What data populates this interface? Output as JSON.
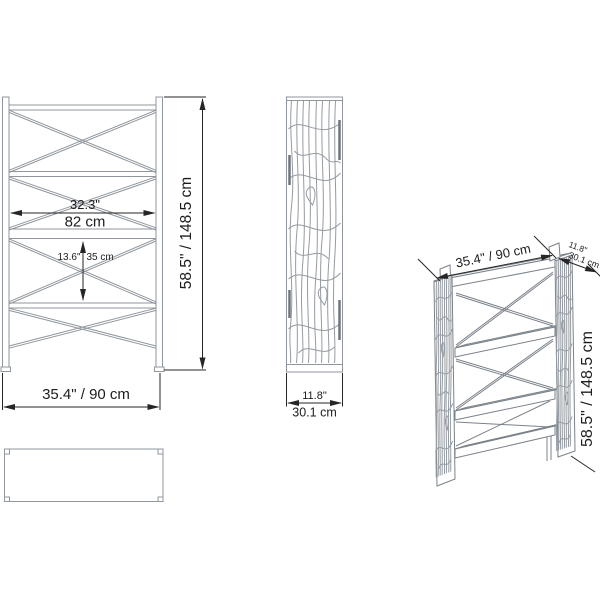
{
  "diagram": {
    "kind": "furniture-dimension-drawing",
    "front": {
      "inner_width_in": "32.3\"",
      "inner_width_cm": "82 cm",
      "shelf_gap_in": "13.6\"",
      "shelf_gap_cm": "35 cm",
      "height": "58.5\" / 148.5 cm",
      "width": "35.4\" / 90 cm"
    },
    "side": {
      "depth_in": "11.8\"",
      "depth_cm": "30.1 cm"
    },
    "perspective": {
      "width": "35.4\" / 90 cm",
      "depth_in": "11.8\"",
      "depth_cm": "30.1 cm",
      "height": "58.5\" / 148.5 cm"
    },
    "colors": {
      "outline": "#8f969d",
      "perspective_outline": "#7b828a",
      "dimension": "#262626",
      "text": "#1d1d1d",
      "background": "#ffffff"
    }
  }
}
